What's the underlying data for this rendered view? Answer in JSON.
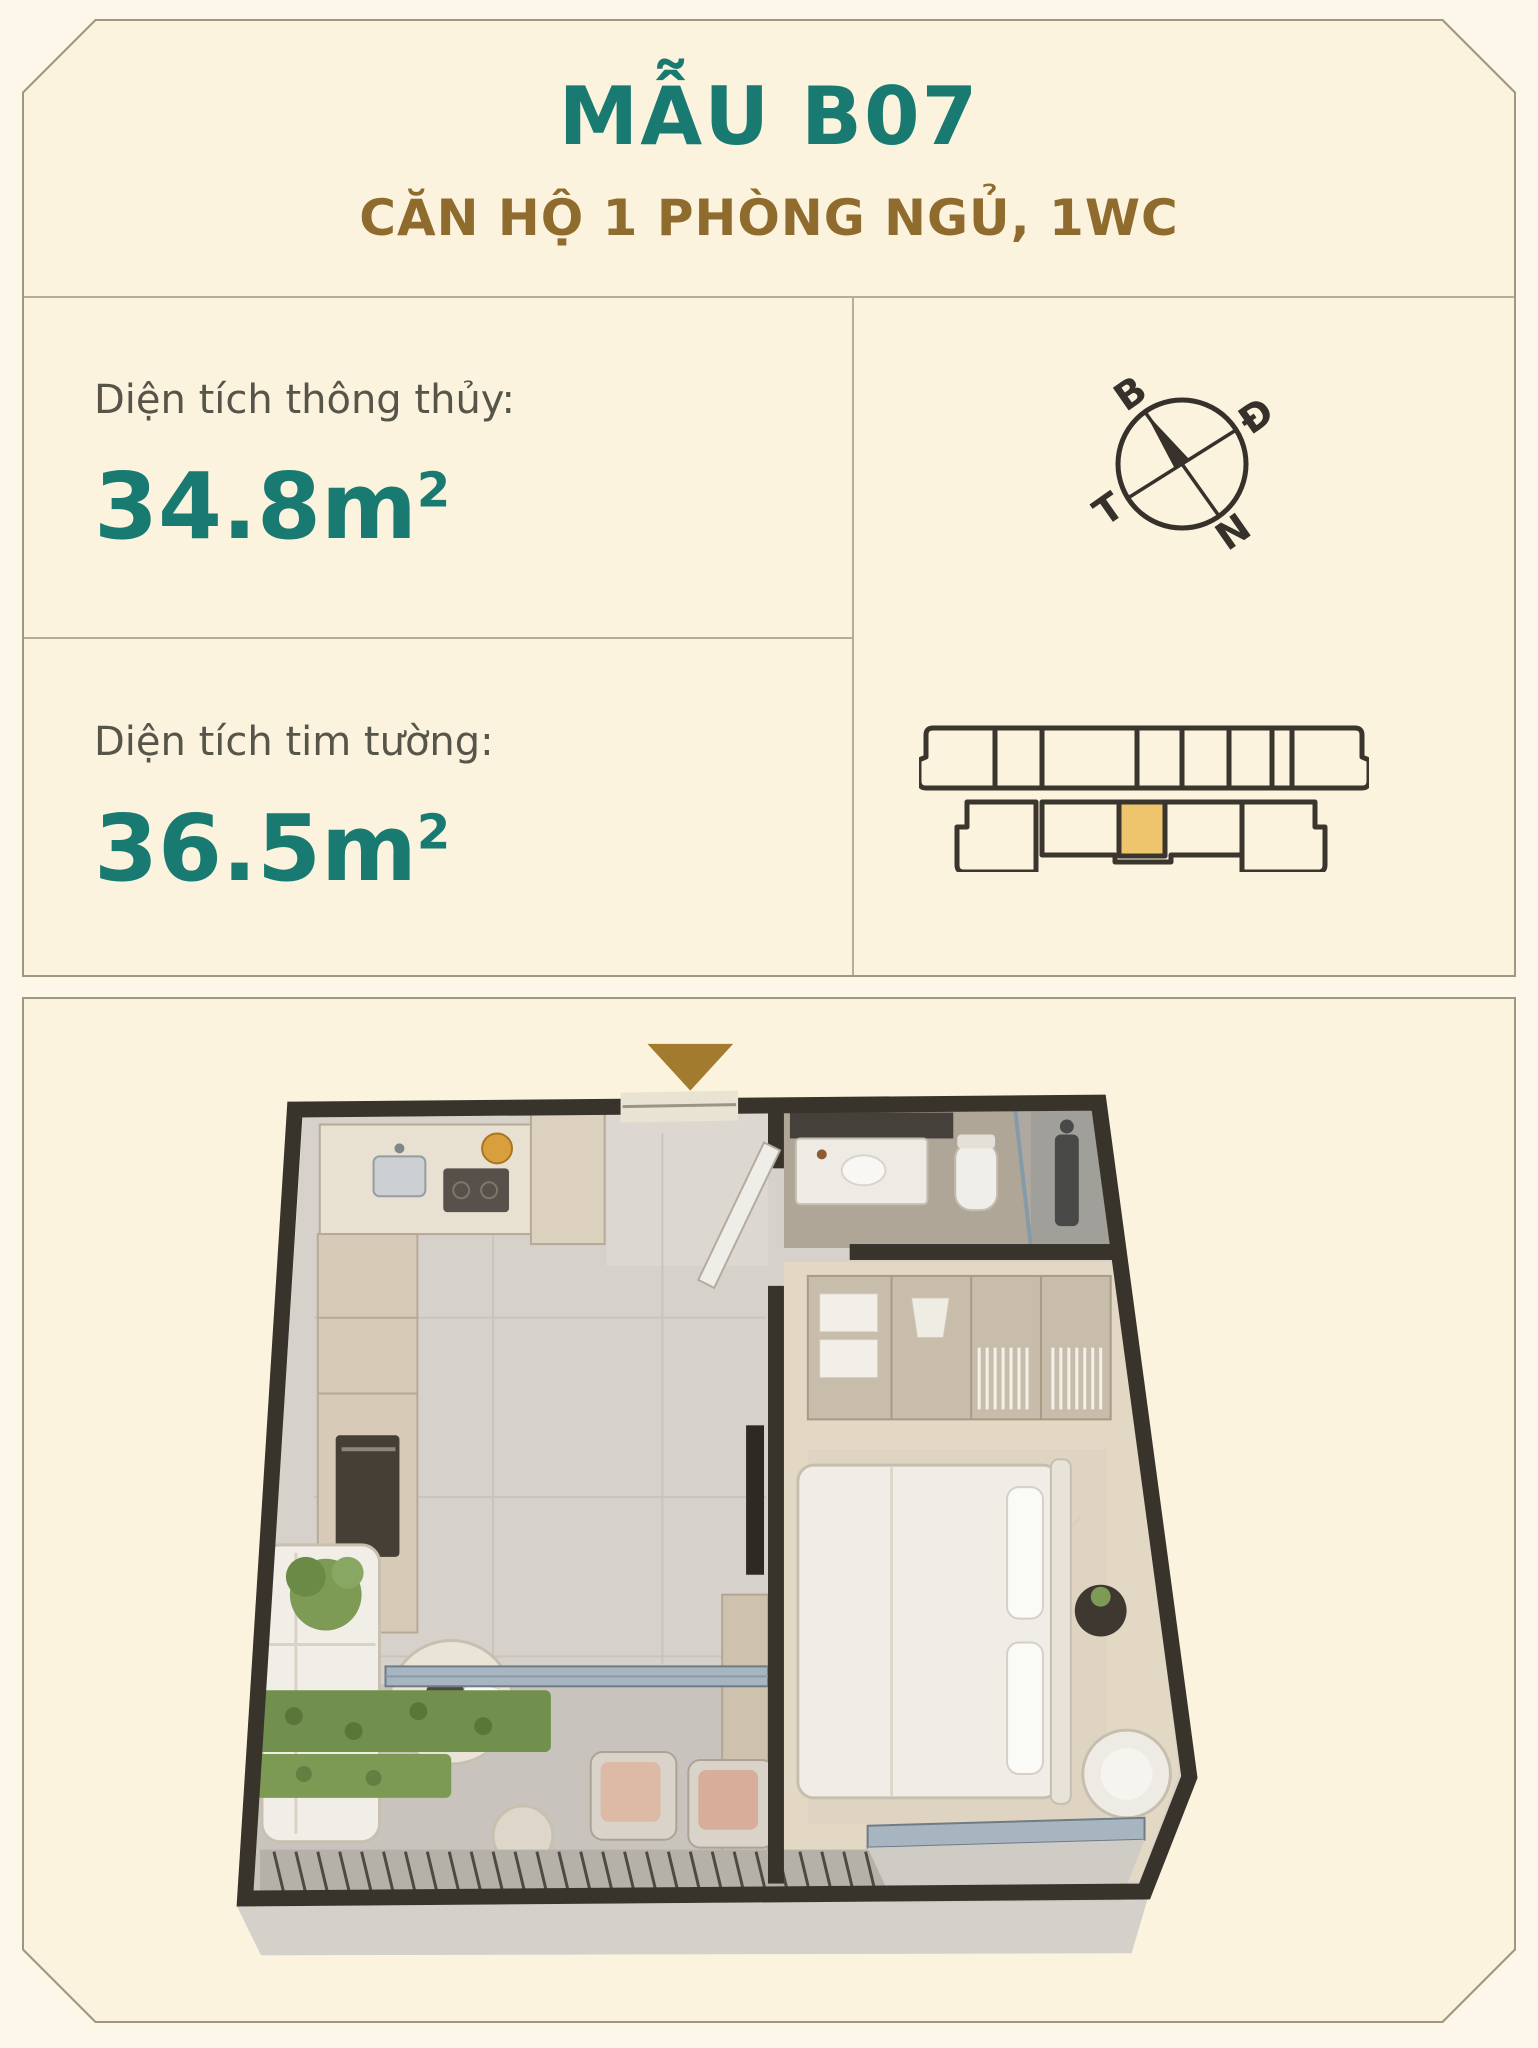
{
  "header": {
    "title": "MẪU B07",
    "subtitle": "CĂN HỘ 1 PHÒNG NGỦ, 1WC"
  },
  "areas": [
    {
      "label": "Diện tích thông thủy:",
      "value": "34.8",
      "unit": "m",
      "exponent": "2"
    },
    {
      "label": "Diện tích tim tường:",
      "value": "36.5",
      "unit": "m",
      "exponent": "2"
    }
  ],
  "compass": {
    "north_label": "B",
    "east_label": "Đ",
    "west_label": "T",
    "south_label": "N"
  },
  "locator": {
    "highlighted_unit": "B07",
    "highlight_color": "#eec46d"
  },
  "floorplan": {
    "marker": "entrance-arrow",
    "rooms": [
      "hallway",
      "kitchen",
      "living",
      "balcony",
      "bathroom",
      "bedroom"
    ]
  },
  "colors": {
    "page_bg": "#fcf7e9",
    "card_bg": "#fbf3dd",
    "card_border": "#a19780",
    "teal": "#187a70",
    "brown": "#8f6b2e",
    "gold_arrow": "#a37b2f",
    "diagram_line": "#3a352d",
    "label_text": "#57544a"
  }
}
